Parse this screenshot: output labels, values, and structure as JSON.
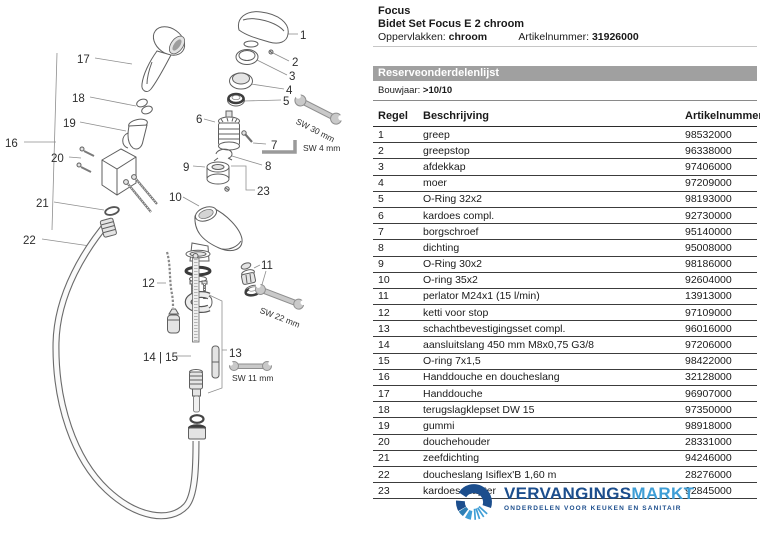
{
  "header": {
    "brand": "Focus",
    "product": "Bidet Set Focus E 2 chroom",
    "surface_label": "Oppervlakken:",
    "surface_value": "chroom",
    "artnum_label": "Artikelnummer:",
    "artnum_value": "31926000"
  },
  "parts_list": {
    "section_title": "Reserveonderdelenlijst",
    "bouwjaar_label": "Bouwjaar:",
    "bouwjaar_value": ">10/10",
    "columns": [
      "Regel",
      "Beschrijving",
      "Artikelnummer"
    ],
    "rows": [
      {
        "regel": "1",
        "beschrijving": "greep",
        "artikelnummer": "98532000"
      },
      {
        "regel": "2",
        "beschrijving": "greepstop",
        "artikelnummer": "96338000"
      },
      {
        "regel": "3",
        "beschrijving": "afdekkap",
        "artikelnummer": "97406000"
      },
      {
        "regel": "4",
        "beschrijving": "moer",
        "artikelnummer": "97209000"
      },
      {
        "regel": "5",
        "beschrijving": "O-Ring 32x2",
        "artikelnummer": "98193000"
      },
      {
        "regel": "6",
        "beschrijving": "kardoes compl.",
        "artikelnummer": "92730000"
      },
      {
        "regel": "7",
        "beschrijving": "borgschroef",
        "artikelnummer": "95140000"
      },
      {
        "regel": "8",
        "beschrijving": "dichting",
        "artikelnummer": "95008000"
      },
      {
        "regel": "9",
        "beschrijving": "O-Ring 30x2",
        "artikelnummer": "98186000"
      },
      {
        "regel": "10",
        "beschrijving": "O-ring 35x2",
        "artikelnummer": "92604000"
      },
      {
        "regel": "11",
        "beschrijving": "perlator M24x1 (15 l/min)",
        "artikelnummer": "13913000"
      },
      {
        "regel": "12",
        "beschrijving": "ketti voor stop",
        "artikelnummer": "97109000"
      },
      {
        "regel": "13",
        "beschrijving": "schachtbevestigingsset compl.",
        "artikelnummer": "96016000"
      },
      {
        "regel": "14",
        "beschrijving": "aansluitslang 450 mm  M8x0,75  G3/8",
        "artikelnummer": "97206000"
      },
      {
        "regel": "15",
        "beschrijving": "O-ring 7x1,5",
        "artikelnummer": "98422000"
      },
      {
        "regel": "16",
        "beschrijving": "Handdouche en doucheslang",
        "artikelnummer": "32128000"
      },
      {
        "regel": "17",
        "beschrijving": "Handdouche",
        "artikelnummer": "96907000"
      },
      {
        "regel": "18",
        "beschrijving": "terugslagklepset DW 15",
        "artikelnummer": "97350000"
      },
      {
        "regel": "19",
        "beschrijving": "gummi",
        "artikelnummer": "98918000"
      },
      {
        "regel": "20",
        "beschrijving": "douchehouder",
        "artikelnummer": "28331000"
      },
      {
        "regel": "21",
        "beschrijving": "zeefdichting",
        "artikelnummer": "94246000"
      },
      {
        "regel": "22",
        "beschrijving": "doucheslang Isiflex'B 1,60 m",
        "artikelnummer": "28276000"
      },
      {
        "regel": "23",
        "beschrijving": "kardoesadapter",
        "artikelnummer": "92845000"
      }
    ]
  },
  "diagram": {
    "callouts": [
      {
        "label": "1"
      },
      {
        "label": "2"
      },
      {
        "label": "3"
      },
      {
        "label": "4"
      },
      {
        "label": "5"
      },
      {
        "label": "6"
      },
      {
        "label": "7"
      },
      {
        "label": "8"
      },
      {
        "label": "9"
      },
      {
        "label": "10"
      },
      {
        "label": "11"
      },
      {
        "label": "12"
      },
      {
        "label": "13"
      },
      {
        "label": "14 | 15"
      },
      {
        "label": "16"
      },
      {
        "label": "17"
      },
      {
        "label": "18"
      },
      {
        "label": "19"
      },
      {
        "label": "20"
      },
      {
        "label": "21"
      },
      {
        "label": "22"
      },
      {
        "label": "23"
      }
    ],
    "tools": [
      {
        "label": "SW 30 mm"
      },
      {
        "label": "SW 4 mm"
      },
      {
        "label": "SW 22 mm"
      },
      {
        "label": "SW 11 mm"
      }
    ]
  },
  "footer_logo": {
    "name_primary": "VERVANGINGS",
    "name_secondary": "MARKT",
    "tagline": "ONDERDELEN VOOR KEUKEN EN SANITAIR",
    "colors": {
      "primary": "#1c4e8d",
      "secondary": "#3f9ed6"
    }
  }
}
